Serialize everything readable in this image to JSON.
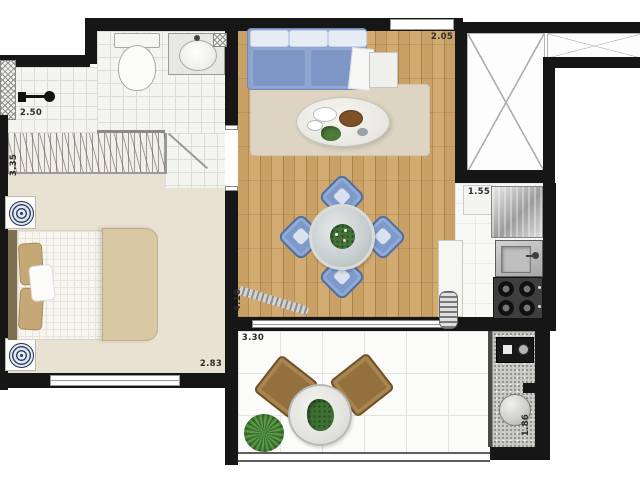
{
  "floorplan": {
    "measurements": {
      "shower": "2.50",
      "bedroom_depth": "3.35",
      "bedroom_width": "2.83",
      "living_entry_width": "2.05",
      "living_depth": "4.10",
      "balcony_width": "3.30",
      "kitchen_width": "1.55",
      "service_depth": "1.86"
    },
    "colors": {
      "wall": "#161616",
      "wood-a": "#c9a066",
      "wood-b": "#b68c52",
      "bedroom-floor": "#e9e2d2",
      "sofa": "#8ba3d1",
      "chair-blue": "#7d9acb",
      "duvet": "#d9c8a4",
      "balcony-chair": "#94703f",
      "plant-green": "#447238",
      "granite": "#c9c9c6"
    }
  }
}
